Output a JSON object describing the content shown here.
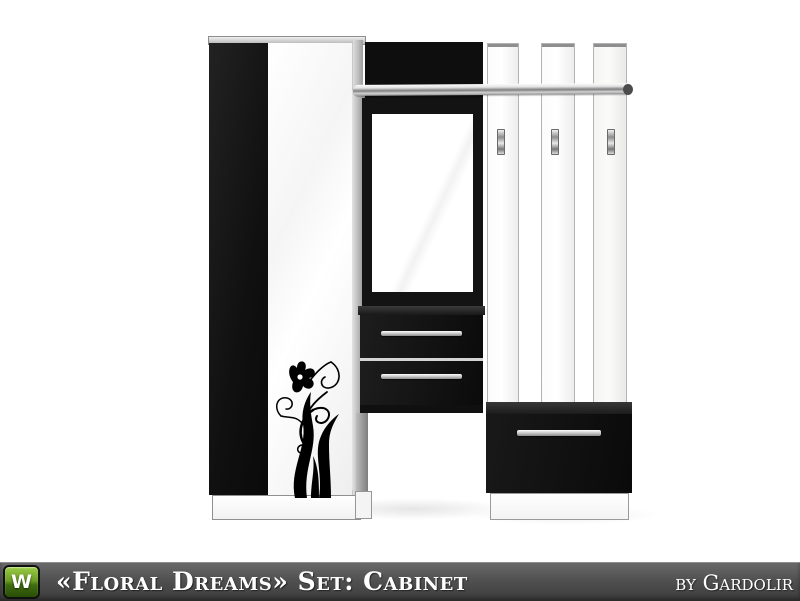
{
  "preview": {
    "background_color": "#ffffff",
    "subject": "black-and-white hallway cabinet set: wardrobe with floral decal, mirror tower with two drawers, chrome shelf rail, three coat-hook panels and shoe bench",
    "furniture_colors": {
      "body_black": "#101010",
      "body_white": "#ffffff",
      "trim_silver": "#c9c9c9"
    }
  },
  "footer": {
    "logo_letter": "W",
    "title": "«Floral Dreams» Set: Cabinet",
    "author": "by Gardolir",
    "bar_top_color": "#6a6a6a",
    "bar_bottom_color": "#3c3c3c",
    "logo_green_top": "#9bcc45",
    "logo_green_bottom": "#2a4d06",
    "text_color": "#ffffff"
  }
}
